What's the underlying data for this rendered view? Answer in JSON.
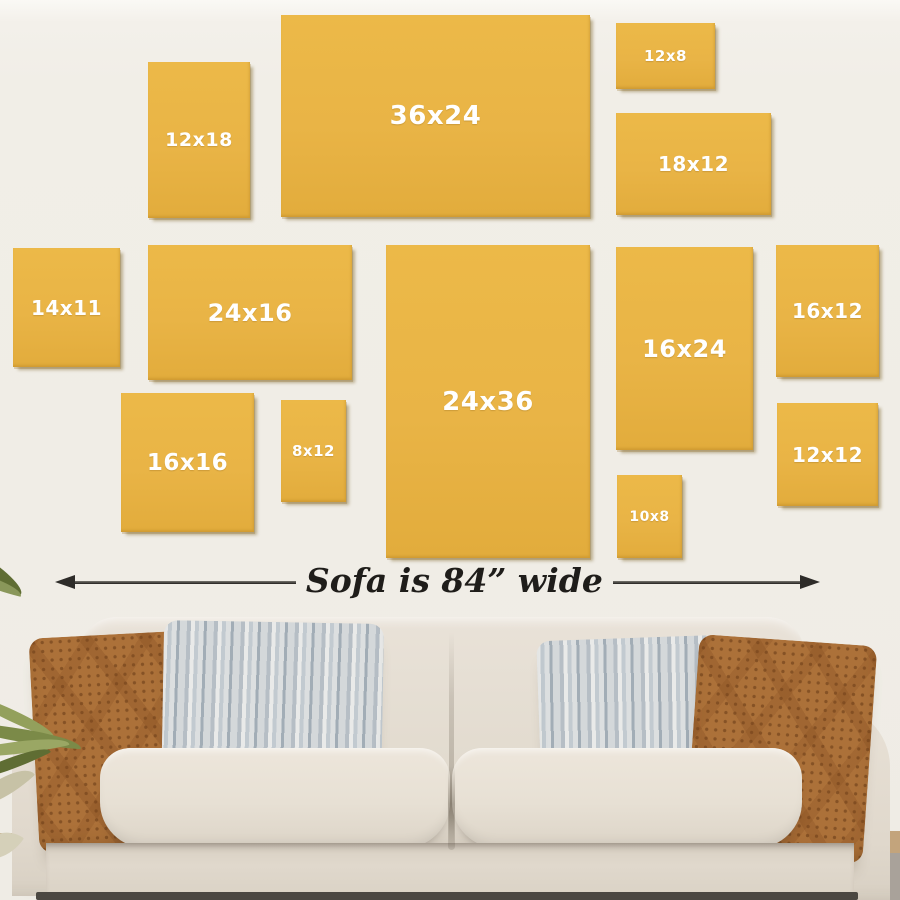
{
  "colors": {
    "wall": "#F1EEE7",
    "wall_top": "#FAF9F5",
    "frame_gold": "#E9B446",
    "label_text": "#FFFFFF",
    "arrow": "#2E2C29",
    "dimension_text": "#1F1D1A",
    "sofa_body": "#E4DDD2",
    "sofa_seat": "#E7E0D4",
    "sofa_skirt": "#DCD4C7",
    "pillow_brown": "#AC7139",
    "pillow_gray": "#CBD1D5",
    "leaf_green": "#7B8A48",
    "leaf_dark": "#5F6D33",
    "leaf_pale": "#C7C2A6",
    "floor_line": "#4B4741",
    "floor_tan": "#B8895C"
  },
  "frames": [
    {
      "label": "12x18",
      "x": 148,
      "y": 62,
      "w": 102,
      "h": 156,
      "fs": 19
    },
    {
      "label": "36x24",
      "x": 281,
      "y": 15,
      "w": 309,
      "h": 202,
      "fs": 26
    },
    {
      "label": "12x8",
      "x": 616,
      "y": 23,
      "w": 99,
      "h": 66,
      "fs": 15
    },
    {
      "label": "18x12",
      "x": 616,
      "y": 113,
      "w": 155,
      "h": 102,
      "fs": 20
    },
    {
      "label": "14x11",
      "x": 13,
      "y": 248,
      "w": 107,
      "h": 119,
      "fs": 20
    },
    {
      "label": "24x16",
      "x": 148,
      "y": 245,
      "w": 204,
      "h": 135,
      "fs": 24
    },
    {
      "label": "24x36",
      "x": 386,
      "y": 245,
      "w": 204,
      "h": 313,
      "fs": 26
    },
    {
      "label": "16x24",
      "x": 616,
      "y": 247,
      "w": 137,
      "h": 203,
      "fs": 24
    },
    {
      "label": "16x12",
      "x": 776,
      "y": 245,
      "w": 103,
      "h": 132,
      "fs": 20
    },
    {
      "label": "16x16",
      "x": 121,
      "y": 393,
      "w": 133,
      "h": 139,
      "fs": 23
    },
    {
      "label": "8x12",
      "x": 281,
      "y": 400,
      "w": 65,
      "h": 102,
      "fs": 15
    },
    {
      "label": "12x12",
      "x": 777,
      "y": 403,
      "w": 101,
      "h": 103,
      "fs": 20
    },
    {
      "label": "10x8",
      "x": 617,
      "y": 475,
      "w": 65,
      "h": 83,
      "fs": 14
    }
  ],
  "dimension": {
    "label": "Sofa is 84” wide"
  }
}
